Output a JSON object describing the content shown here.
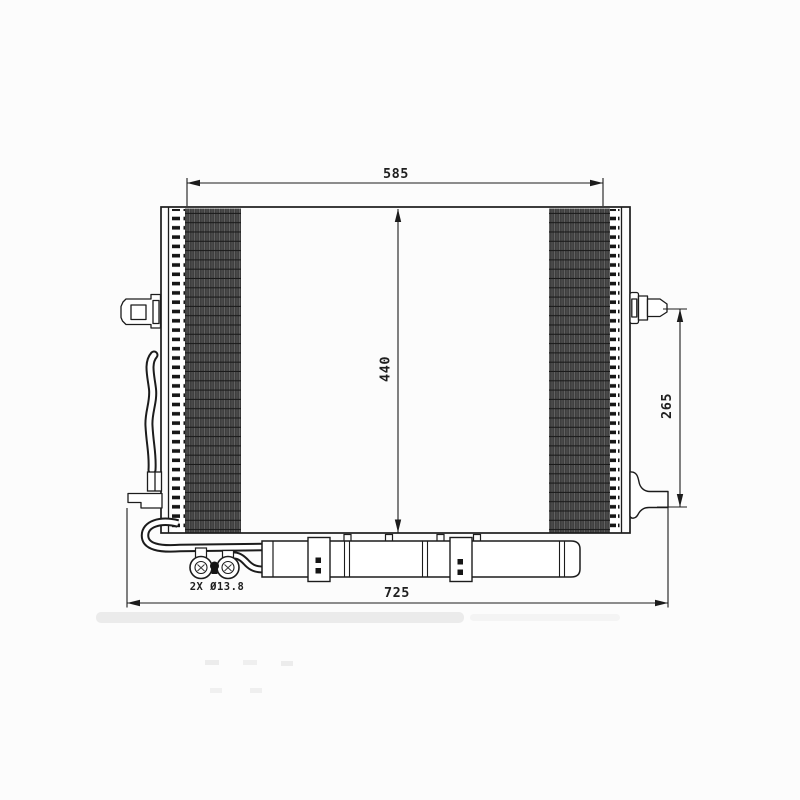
{
  "page": {
    "background": "#fcfcfc",
    "line_color": "#1c1c1c",
    "fin_fill": "#4e4e4e"
  },
  "drawing": {
    "type": "technical-dimension-drawing",
    "subject": "automotive-condenser-front-view",
    "dimensions": {
      "top_width": "585",
      "core_height": "440",
      "right_span": "265",
      "overall_width": "725",
      "port_note": "2X Ø13.8"
    }
  }
}
